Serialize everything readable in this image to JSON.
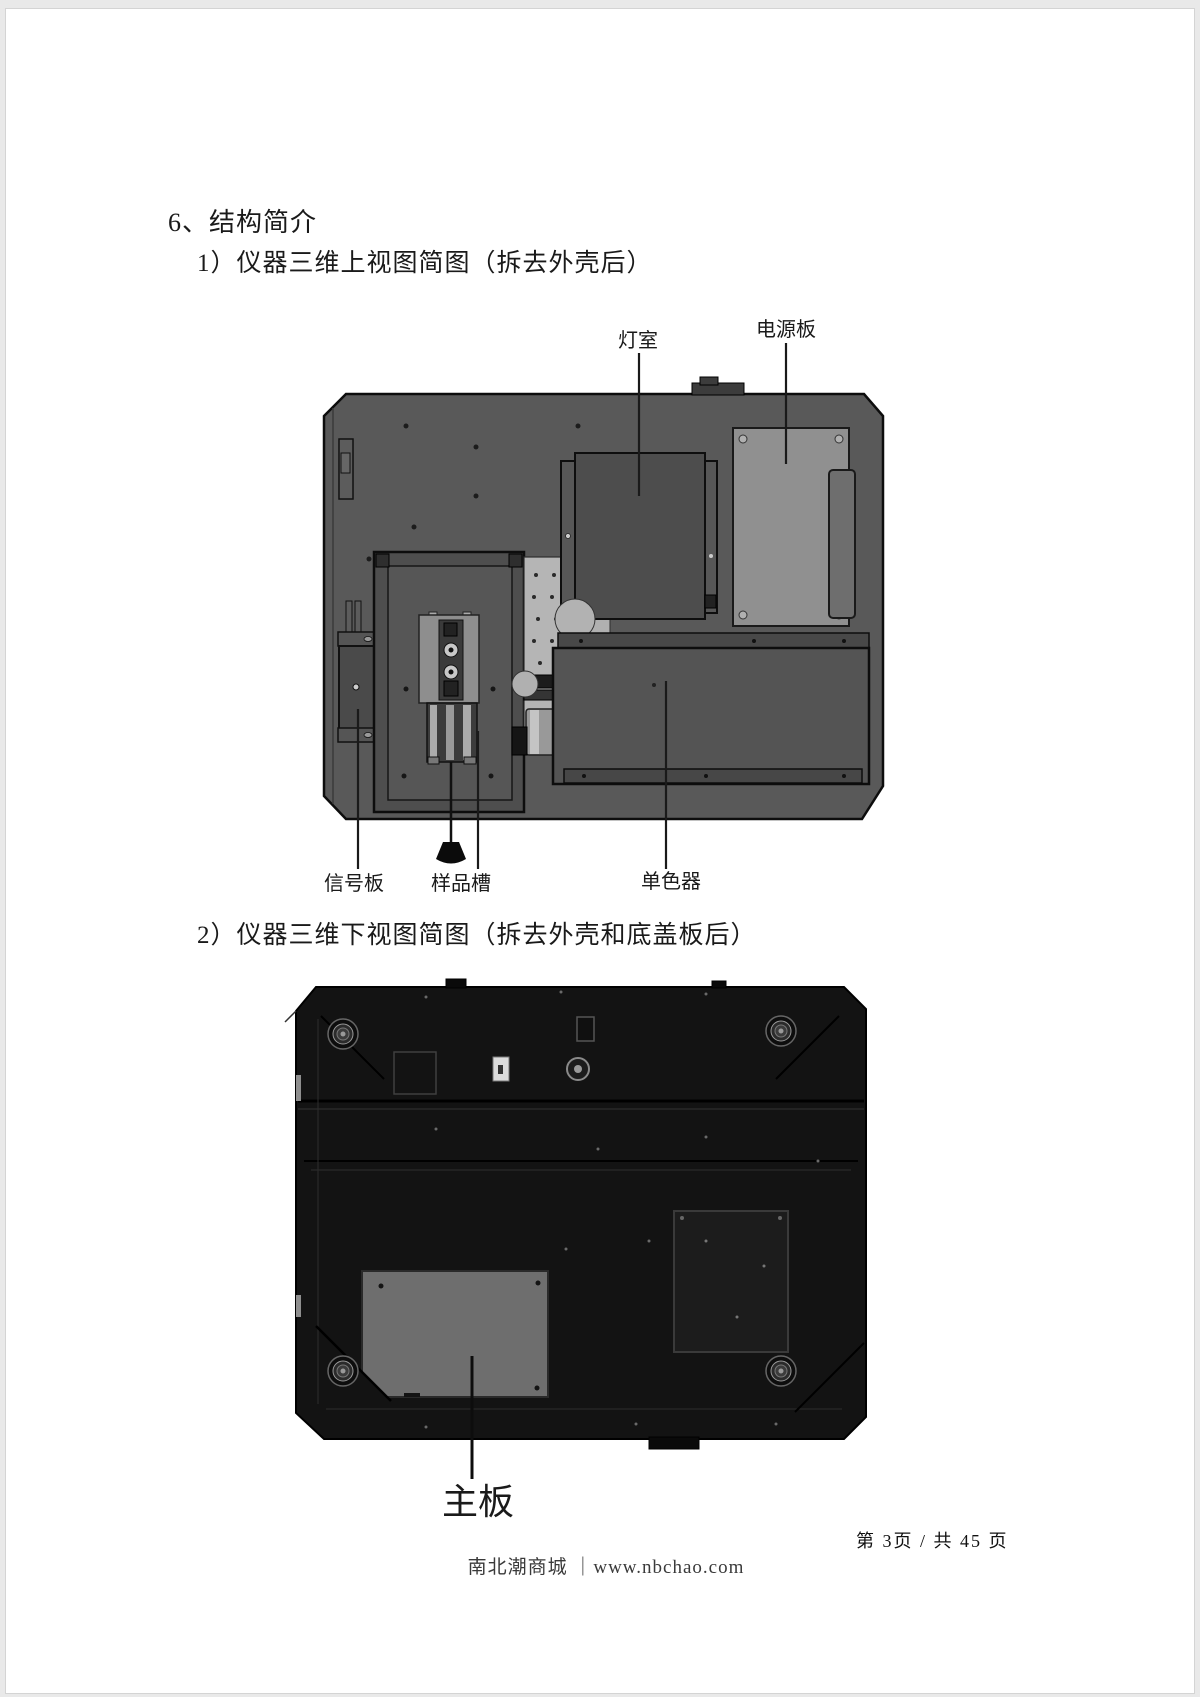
{
  "document": {
    "heading": "6、结构简介",
    "subheading_1": "1）仪器三维上视图简图（拆去外壳后）",
    "subheading_2": "2）仪器三维下视图简图（拆去外壳和底盖板后）",
    "footer": {
      "page_indicator": "第 3页 / 共 45 页",
      "watermark": "南北潮商城 ｜www.nbchao.com"
    }
  },
  "figure_top_view": {
    "title_ref": "仪器三维上视图简图",
    "labels": {
      "lamp_room": "灯室",
      "power_board": "电源板",
      "signal_board": "信号板",
      "sample_slot": "样品槽",
      "monochromator": "单色器"
    }
  },
  "figure_bottom_view": {
    "title_ref": "仪器三维下视图简图",
    "labels": {
      "main_board": "主板"
    }
  },
  "colors": {
    "chassis_plate_gray": "#595959",
    "lamp_house_gray": "#4d4d4d",
    "base_plate_light_gray": "#b5b5b5",
    "power_board_gray": "#909090",
    "monochromator_gray": "#545454",
    "bottom_body_black": "#131313",
    "main_board_gray": "#6e6e6e",
    "label_text": "#1a1a1a"
  }
}
